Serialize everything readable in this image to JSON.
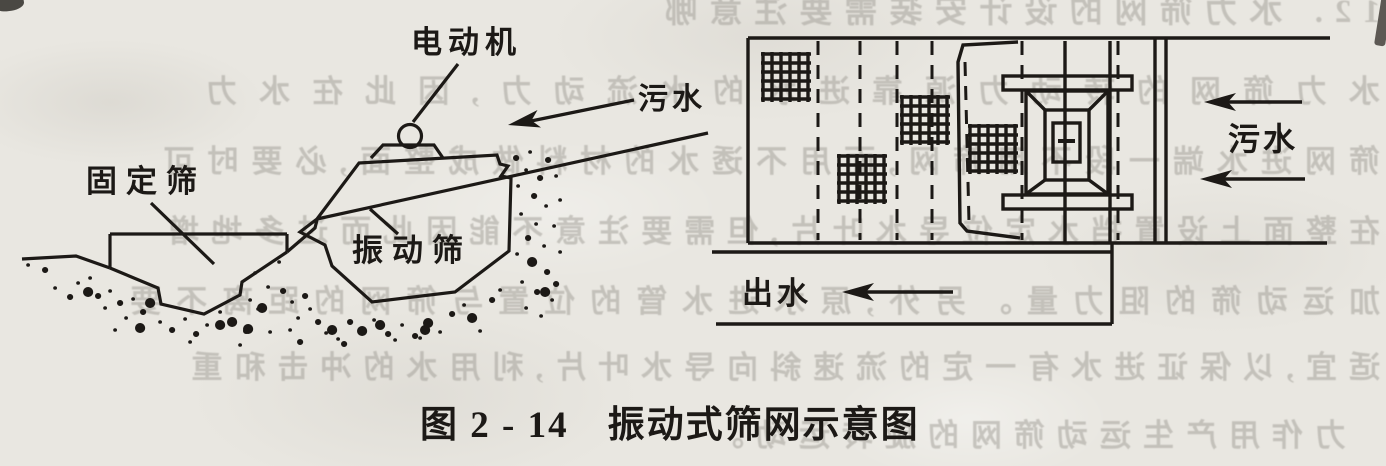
{
  "figure": {
    "caption": "图 2 - 14　振动式筛网示意图",
    "left_diagram": {
      "motor_label": "电动机",
      "sewage_label": "污水",
      "fixed_screen_label": "固定筛",
      "vibrating_screen_label": "振动筛"
    },
    "right_diagram": {
      "sewage_label": "污水",
      "outflow_label": "出水"
    }
  },
  "colors": {
    "paper": "#e9e7e1",
    "ink": "#1c1916",
    "bleedthrough": "#9f9c95"
  },
  "bleedthrough_lines": [
    {
      "text": "12. 水力筛网的设计安装需要注意哪"
    },
    {
      "text": "水力筛网的转动力源靠进水的水流动力,因此在水力"
    },
    {
      "text": "筛网进水端一段不用筛网,而用不透水的材料做成整面,必要时可"
    },
    {
      "text": "在整面上设置挡水定位导水叶片,但需要注意不能因此而过多地增"
    },
    {
      "text": "加运动筛的阻力量。另外,原水进水管的位置与筛网的距离不要"
    },
    {
      "text": "适宜,以保证进水有一定的流速斜向导水叶片,利用水的冲击和重"
    },
    {
      "text": "力作用产生运动筛网的旋转运动。"
    }
  ]
}
